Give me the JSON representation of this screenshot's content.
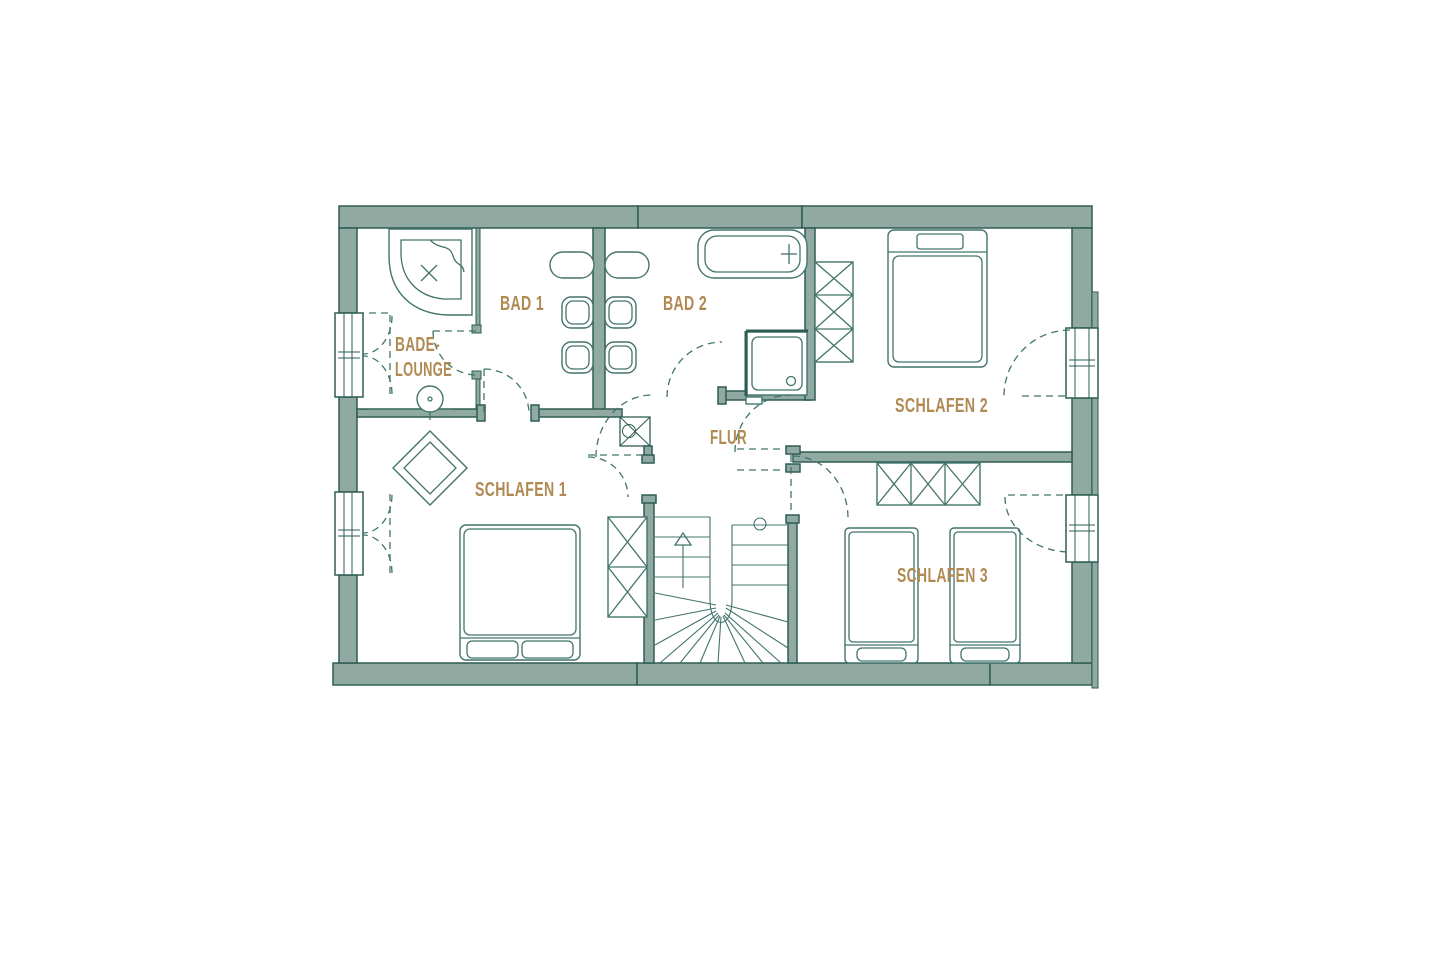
{
  "floorplan": {
    "labels": {
      "bade_lounge_line1": "BADE-",
      "bade_lounge_line2": "LOUNGE",
      "bad1": "BAD 1",
      "bad2": "BAD 2",
      "flur": "FLUR",
      "schlafen1": "SCHLAFEN 1",
      "schlafen2": "SCHLAFEN 2",
      "schlafen3": "SCHLAFEN 3"
    },
    "colors": {
      "background": "#ffffff",
      "wall_fill": "#90a9a1",
      "wall_outline": "#2e5d54",
      "furniture_line": "#42746b",
      "label_text": "#b08a52"
    }
  }
}
